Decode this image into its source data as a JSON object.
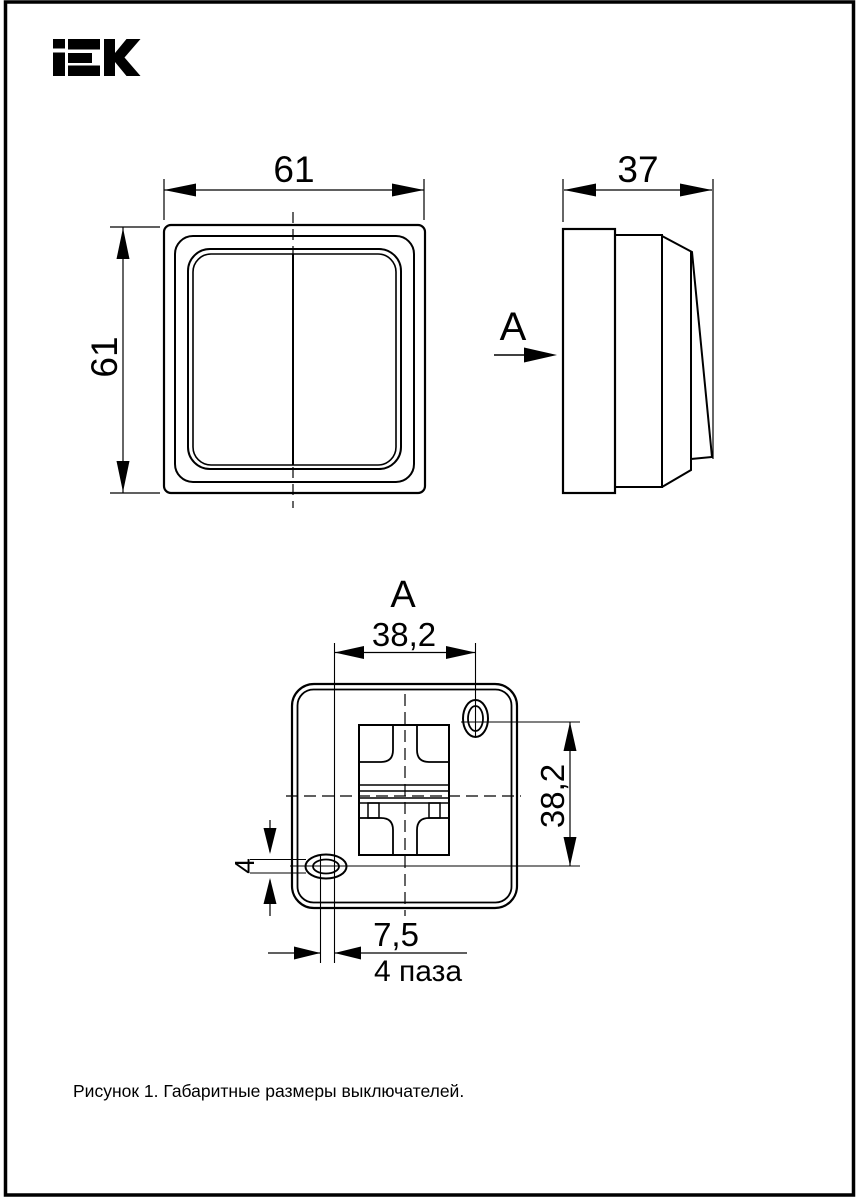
{
  "logo": {
    "text": "IEK"
  },
  "drawing": {
    "labels": {
      "front_width": "61",
      "front_height": "61",
      "side_depth": "37",
      "side_section_label": "А",
      "section_title": "А",
      "section_width": "38,2",
      "section_height": "38,2",
      "slot_height": "4",
      "slot_offset": "7,5",
      "slots_note": "4 паза"
    },
    "colors": {
      "ink": "#000000",
      "paper": "#ffffff"
    }
  },
  "caption": {
    "text": "Рисунок 1. Габаритные размеры выключателей."
  }
}
